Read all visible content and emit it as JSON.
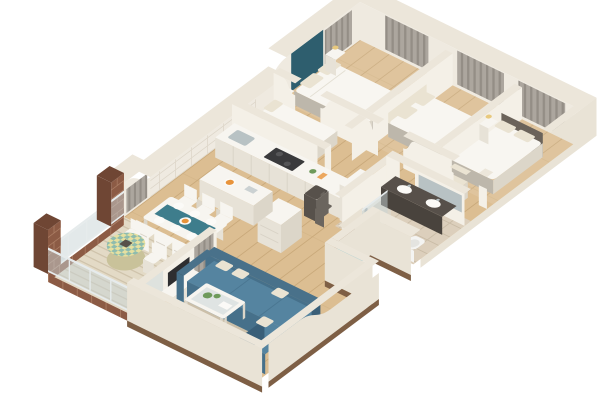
{
  "scene": {
    "type": "3d-floor-plan-render",
    "style": "isometric cutaway apartment",
    "background": "#ffffff",
    "visible_text": ""
  },
  "colors": {
    "bg": "#ffffff",
    "wall_top": "#ece6da",
    "wall_face": "#e9e3d6",
    "wall_face_light": "#f4f0e7",
    "wall_face_shade": "#d9d2c3",
    "wall_inner": "#efeae0",
    "under_slab": "#7e5f45",
    "floor_wood": "#dcbe92",
    "floor_wood_line": "#c9a97a",
    "floor_deck": "#e3dac6",
    "deck_line": "#cfc3ab",
    "tile": "#dccfbc",
    "tile_line": "#c9bca6",
    "rug": "#cbbfa9",
    "rug_border": "#bdb095",
    "accent_teal": "#2e5e6e",
    "curtain": "#aca69e",
    "curtain_stripe": "#948e86",
    "white_brick": "#efeae1",
    "white_brick_line": "#ded7ca",
    "brick": "#8c5b45",
    "brick_dark": "#6f4634",
    "brick_mortar": "#a97b62",
    "glass": "#c7d3d6",
    "glass_rail": "#e6ebec",
    "white_furn": "#f7f5f0",
    "white_furn_shade": "#e7e2d7",
    "white_furn_side": "#dcd6c9",
    "dark_appliance": "#3a3a3c",
    "counter_line": "#d8d2c6",
    "runner_teal": "#3e7d8c",
    "plate": "#fbfaf7",
    "orange": "#e8933a",
    "plant": "#6e9a5b",
    "dark_wood": "#6b635a",
    "dark_wood2": "#57514b",
    "greige": "#bdb7ab",
    "linen": "#f8f6f1",
    "linen_shade": "#ece8de",
    "vanity_dark": "#57504a",
    "vanity_front": "#49433d",
    "chrome": "#b8c2c4",
    "toilet": "#f4f4f2",
    "lamp": "#e8c97e",
    "luggage1": "#57514b",
    "luggage2": "#6b655e",
    "tv": "#2e2e30",
    "pillow": "#eae3d2",
    "sofa_top": "#5584a0",
    "sofa_front": "#46708a",
    "sofa_side": "#3a5f78",
    "sofa_back": "#49718a",
    "door_wood": "#8a6648",
    "entry_arrow": "#2aa0c0"
  },
  "rooms": [
    {
      "id": "master-bedroom",
      "furniture": [
        "double-bed",
        "white-duvet",
        "pillows",
        "teal-accent-wall",
        "nightstands",
        "table-lamps",
        "foot-bench",
        "curtained-window"
      ]
    },
    {
      "id": "bedroom-2",
      "furniture": [
        "double-bed",
        "upholstered-headboard",
        "curtained-window"
      ]
    },
    {
      "id": "bedroom-3",
      "furniture": [
        "bed",
        "dark-headboard",
        "armchair",
        "tall-nightstand",
        "table-lamp",
        "curtained-window"
      ]
    },
    {
      "id": "small-bedroom",
      "furniture": [
        "single-bed",
        "pillows"
      ]
    },
    {
      "id": "bathroom",
      "furniture": [
        "dark-double-vanity",
        "two-sinks",
        "mirror",
        "glass-shower",
        "toilet",
        "tiled-floor"
      ]
    },
    {
      "id": "kitchen",
      "furniture": [
        "counter-run",
        "cooktop",
        "sink",
        "oven-column",
        "island",
        "bar-stools",
        "fruit-bowl",
        "white-brick-backsplash"
      ]
    },
    {
      "id": "dining-area",
      "furniture": [
        "white-table",
        "teal-runner",
        "six-chairs",
        "plates"
      ]
    },
    {
      "id": "living-room",
      "furniture": [
        "blue-sectional-sofa",
        "cream-pillows",
        "coffee-table",
        "glass-top",
        "plants",
        "tv",
        "tv-console",
        "area-rug",
        "dresser"
      ]
    },
    {
      "id": "hallway",
      "furniture": [
        "luggage-bags",
        "entry-door",
        "entry-arrow"
      ]
    },
    {
      "id": "balcony",
      "furniture": [
        "round-table",
        "checkered-tablecloth",
        "two-cafe-chairs",
        "glass-railing",
        "brick-pillars",
        "striped-decking"
      ]
    }
  ]
}
